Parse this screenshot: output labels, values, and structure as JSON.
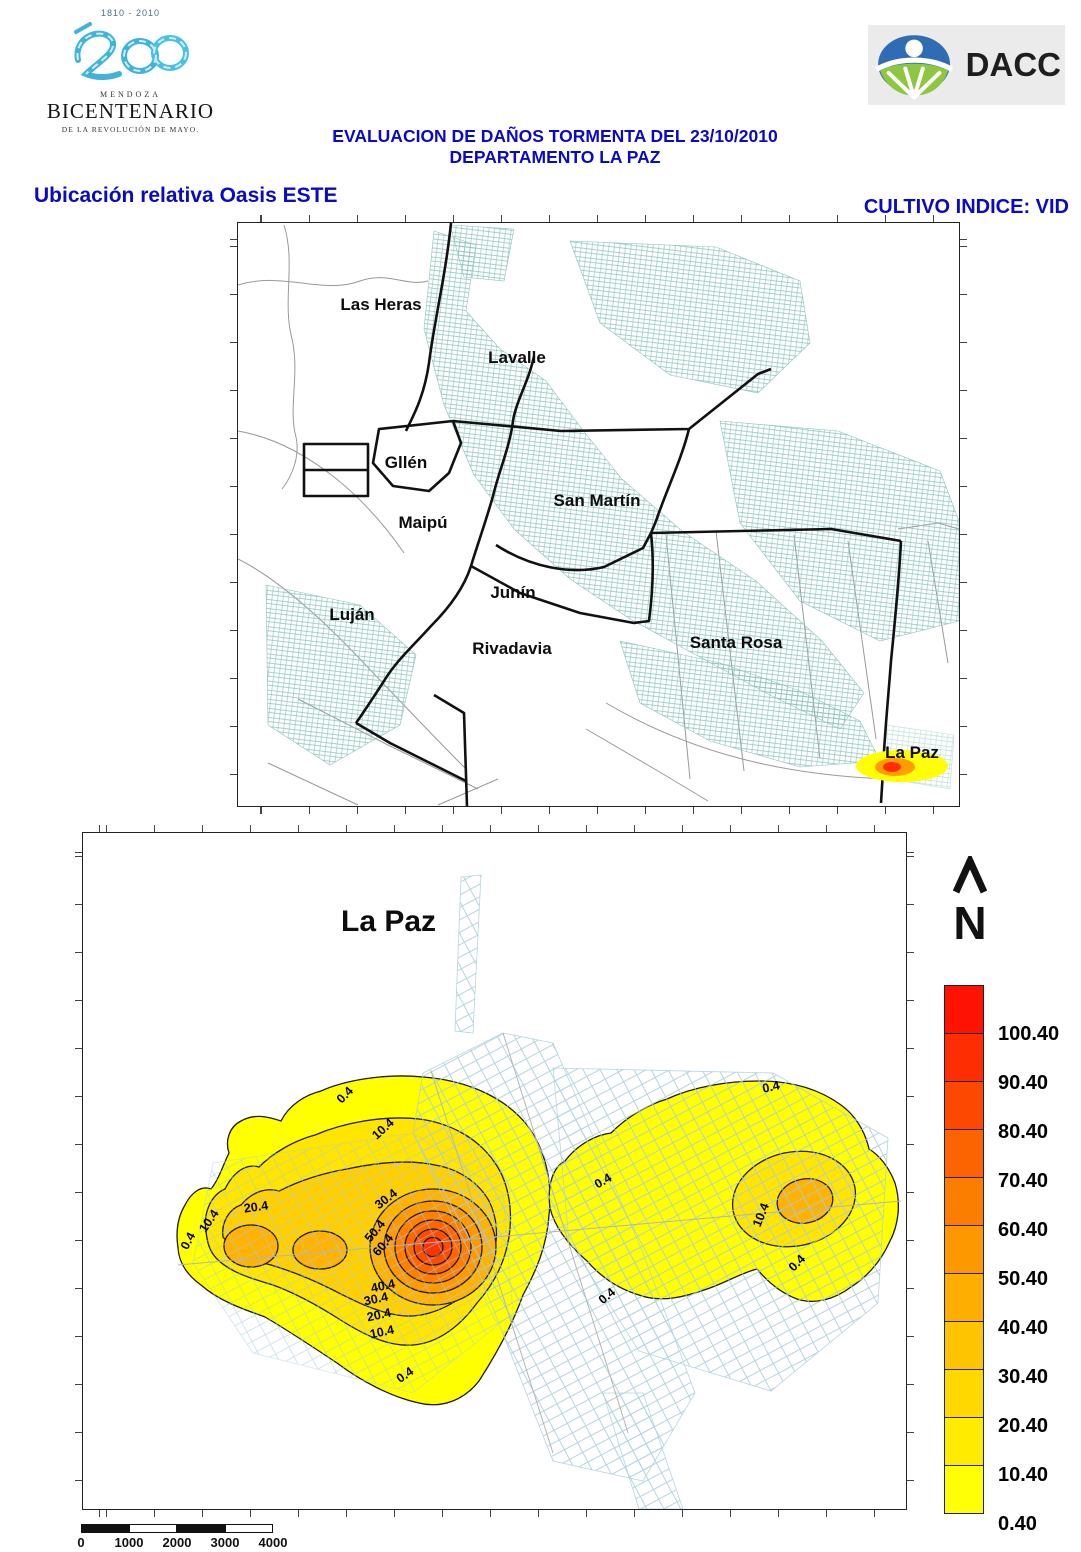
{
  "header": {
    "bicentenario": {
      "years": "1810 - 2010",
      "region": "MENDOZA",
      "name": "BICENTENARIO",
      "subtitle": "DE LA REVOLUCIÓN DE MAYO."
    },
    "dacc": {
      "label": "DACC"
    },
    "title_line1": "EVALUACION DE DAÑOS TORMENTA DEL 23/10/2010",
    "title_line2": "DEPARTAMENTO LA PAZ",
    "left_subtitle": "Ubicación relativa Oasis ESTE",
    "right_subtitle": "CULTIVO INDICE: VID"
  },
  "colors": {
    "accent_blue": "#0a0ac6",
    "cadastral_teal": "#8ac4bd",
    "parcel_blue": "#a9cddb",
    "hotspot_red": "#ff3300"
  },
  "upper_map": {
    "department_labels": [
      {
        "text": "Las Heras",
        "x": 143,
        "y": 82
      },
      {
        "text": "Lavalle",
        "x": 279,
        "y": 135
      },
      {
        "text": "Gllén",
        "x": 168,
        "y": 240
      },
      {
        "text": "Maipú",
        "x": 185,
        "y": 300
      },
      {
        "text": "San Martín",
        "x": 359,
        "y": 278
      },
      {
        "text": "Junín",
        "x": 275,
        "y": 370
      },
      {
        "text": "Luján",
        "x": 114,
        "y": 392
      },
      {
        "text": "Rivadavia",
        "x": 274,
        "y": 426
      },
      {
        "text": "Santa Rosa",
        "x": 498,
        "y": 420
      },
      {
        "text": "La Paz",
        "x": 674,
        "y": 530
      }
    ]
  },
  "lower_map": {
    "title": "La Paz",
    "north_label": "N",
    "contour_levels": [
      0.4,
      10.4,
      20.4,
      30.4,
      40.4,
      50.4,
      60.4,
      70.4,
      80.4,
      90.4,
      100.4
    ],
    "contour_labels": [
      {
        "text": "0.4",
        "x": 105,
        "y": 408,
        "rot": -62
      },
      {
        "text": "10.4",
        "x": 126,
        "y": 388,
        "rot": -55
      },
      {
        "text": "20.4",
        "x": 173,
        "y": 374,
        "rot": -8
      },
      {
        "text": "0.4",
        "x": 262,
        "y": 262,
        "rot": -45
      },
      {
        "text": "10.4",
        "x": 300,
        "y": 296,
        "rot": -42
      },
      {
        "text": "30.4",
        "x": 303,
        "y": 366,
        "rot": -38
      },
      {
        "text": "50.4",
        "x": 292,
        "y": 398,
        "rot": -50
      },
      {
        "text": "60.4",
        "x": 300,
        "y": 412,
        "rot": -50
      },
      {
        "text": "40.4",
        "x": 300,
        "y": 453,
        "rot": -12
      },
      {
        "text": "30.4",
        "x": 293,
        "y": 466,
        "rot": -12
      },
      {
        "text": "20.4",
        "x": 296,
        "y": 482,
        "rot": -12
      },
      {
        "text": "10.4",
        "x": 299,
        "y": 499,
        "rot": -12
      },
      {
        "text": "0.4",
        "x": 322,
        "y": 542,
        "rot": -35
      },
      {
        "text": "0.4",
        "x": 688,
        "y": 254,
        "rot": -12
      },
      {
        "text": "0.4",
        "x": 520,
        "y": 348,
        "rot": -30
      },
      {
        "text": "10.4",
        "x": 678,
        "y": 382,
        "rot": -68
      },
      {
        "text": "0.4",
        "x": 714,
        "y": 430,
        "rot": -45
      },
      {
        "text": "0.4",
        "x": 524,
        "y": 463,
        "rot": -40
      }
    ],
    "scale_bar": {
      "labels": [
        "0",
        "1000",
        "2000",
        "3000",
        "4000"
      ]
    },
    "legend": {
      "items": [
        {
          "label": "100.40",
          "color": "#fe1202"
        },
        {
          "label": "90.40",
          "color": "#fe2e02"
        },
        {
          "label": "80.40",
          "color": "#fd4801"
        },
        {
          "label": "70.40",
          "color": "#fc6301"
        },
        {
          "label": "60.40",
          "color": "#fc7e01"
        },
        {
          "label": "50.40",
          "color": "#fd9801"
        },
        {
          "label": "40.40",
          "color": "#feae00"
        },
        {
          "label": "30.40",
          "color": "#fec301"
        },
        {
          "label": "20.40",
          "color": "#ffd800"
        },
        {
          "label": "10.40",
          "color": "#ffeb00"
        },
        {
          "label": "0.40",
          "color": "#ffff05"
        }
      ]
    }
  }
}
